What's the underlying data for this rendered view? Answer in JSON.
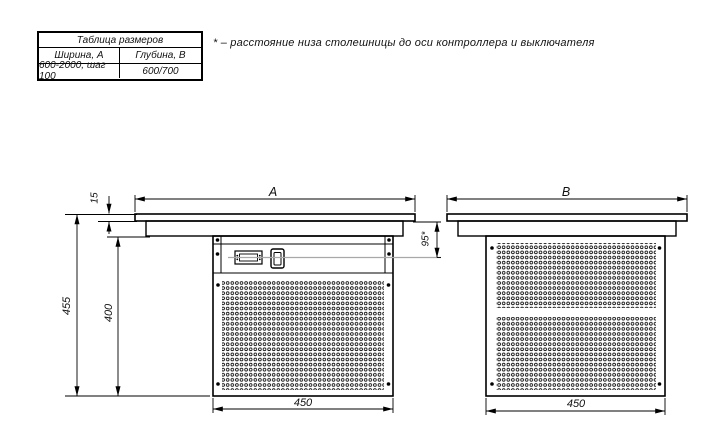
{
  "size_table": {
    "title": "Таблица размеров",
    "col1_header": "Ширина, А",
    "col2_header": "Глубина, В",
    "col1_value": "600-2000, шаг 100",
    "col2_value": "600/700"
  },
  "footnote": "* – расстояние низа столешницы до оси контроллера и выключателя",
  "front_view": {
    "width_label": "A",
    "top_thickness": "15",
    "total_height": "455",
    "body_height": "400",
    "body_width": "450",
    "controller_axis_offset": "95*"
  },
  "side_view": {
    "depth_label": "B",
    "body_depth": "450"
  },
  "colors": {
    "line": "#000000",
    "centerline": "#a8a8a8"
  }
}
